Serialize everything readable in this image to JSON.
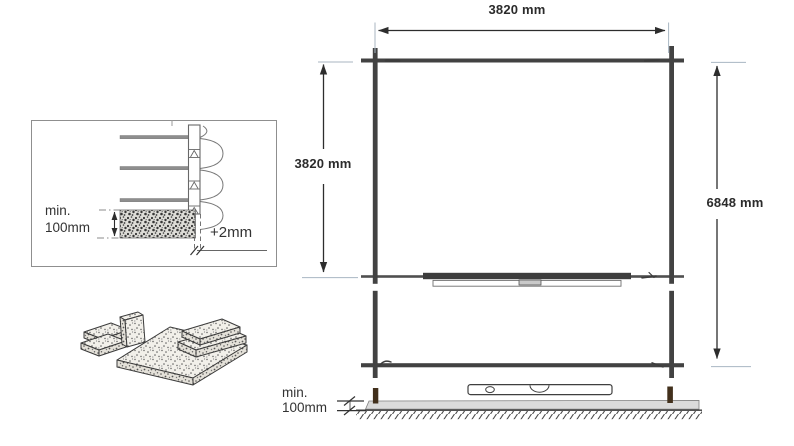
{
  "detail_inset": {
    "min_depth_line1": "min.",
    "min_depth_line2": "100mm",
    "gap_tolerance_label": "+2mm"
  },
  "plan_view": {
    "top_width_label": "3820 mm",
    "left_depth_label": "3820 mm",
    "right_length_label": "6848 mm"
  },
  "side_view": {
    "min_height_line1": "min.",
    "min_height_line2": "100mm"
  },
  "colors": {
    "line": "#3f3f3f",
    "extension_line": "#a8b6c2",
    "slab_fill": "#dbdbdb",
    "post": "#42301c",
    "text": "#2d2d2d"
  }
}
